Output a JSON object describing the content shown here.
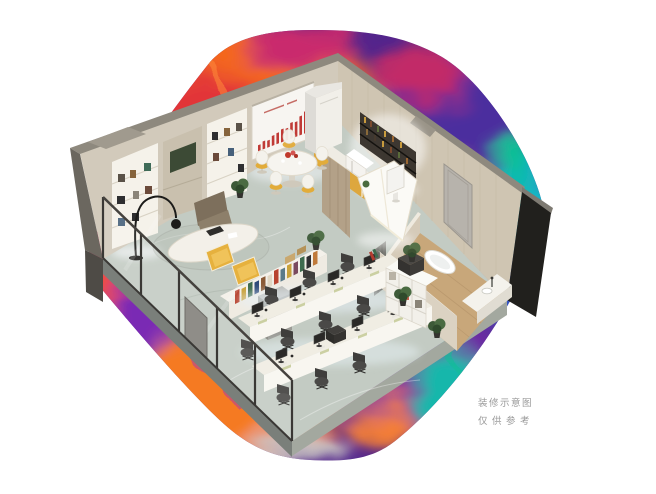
{
  "caption": {
    "line1": "装修示意图",
    "line2": "仅供参考"
  },
  "palette": {
    "background": "#ffffff",
    "caption_gray": "#9a9a9a",
    "swirl_base_purple": "#52258c",
    "swirl_orange": "#f4661e",
    "swirl_red": "#e23439",
    "swirl_magenta": "#c92a6d",
    "swirl_indigo": "#4b2d9e",
    "swirl_teal": "#14b4c9",
    "swirl_green_teal": "#0fbf96",
    "swirl_gray": "#c9c5c3",
    "floor_stone": "#c3cbc3",
    "wall_taupe": "#d2cabb",
    "wood_wall": "#cfc5b2",
    "wood_floor": "#c8a77a",
    "accent_yellow": "#e2ac3a",
    "glass_frame": "#3a3835",
    "dark_outer_wall": "#21201d",
    "screen_chart_red": "#c03a36"
  }
}
